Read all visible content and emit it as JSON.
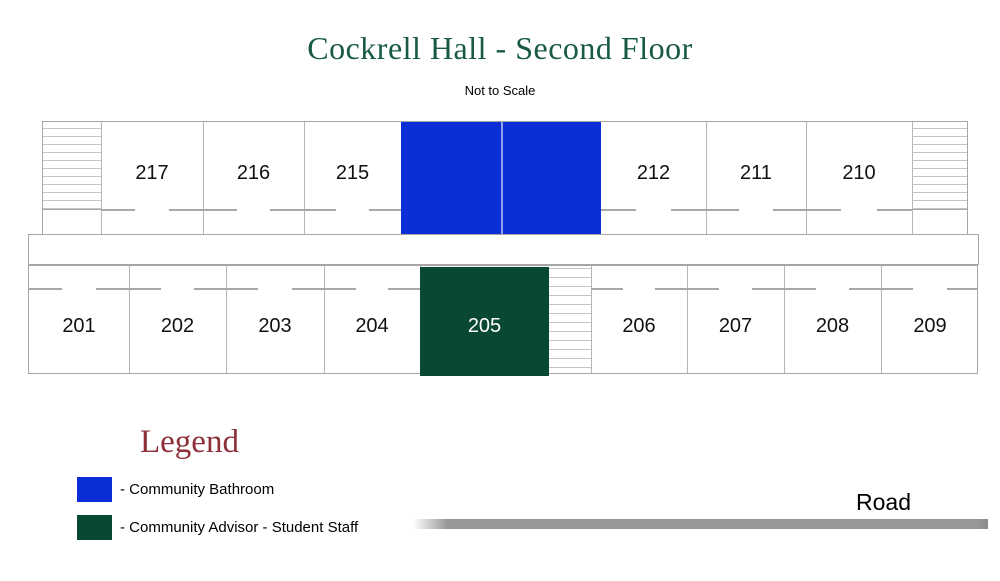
{
  "header": {
    "title": "Cockrell Hall - Second Floor",
    "subtitle": "Not to Scale"
  },
  "plan": {
    "top_row": {
      "rooms": [
        "217",
        "216",
        "215",
        "212",
        "211",
        "210"
      ]
    },
    "bottom_row": {
      "rooms": [
        "201",
        "202",
        "203",
        "204",
        "206",
        "207",
        "208",
        "209"
      ],
      "advisor_room": "205"
    }
  },
  "legend": {
    "heading": "Legend",
    "items": [
      {
        "swatch_color": "#0b2ed6",
        "label": "- Community Bathroom"
      },
      {
        "swatch_color": "#0a4836",
        "label": "- Community Advisor - Student Staff"
      }
    ]
  },
  "road": {
    "label": "Road"
  },
  "colors": {
    "bathroom": "#0b2ed6",
    "advisor": "#0a4836",
    "title_green": "#185b41",
    "legend_maroon": "#8d3038"
  }
}
